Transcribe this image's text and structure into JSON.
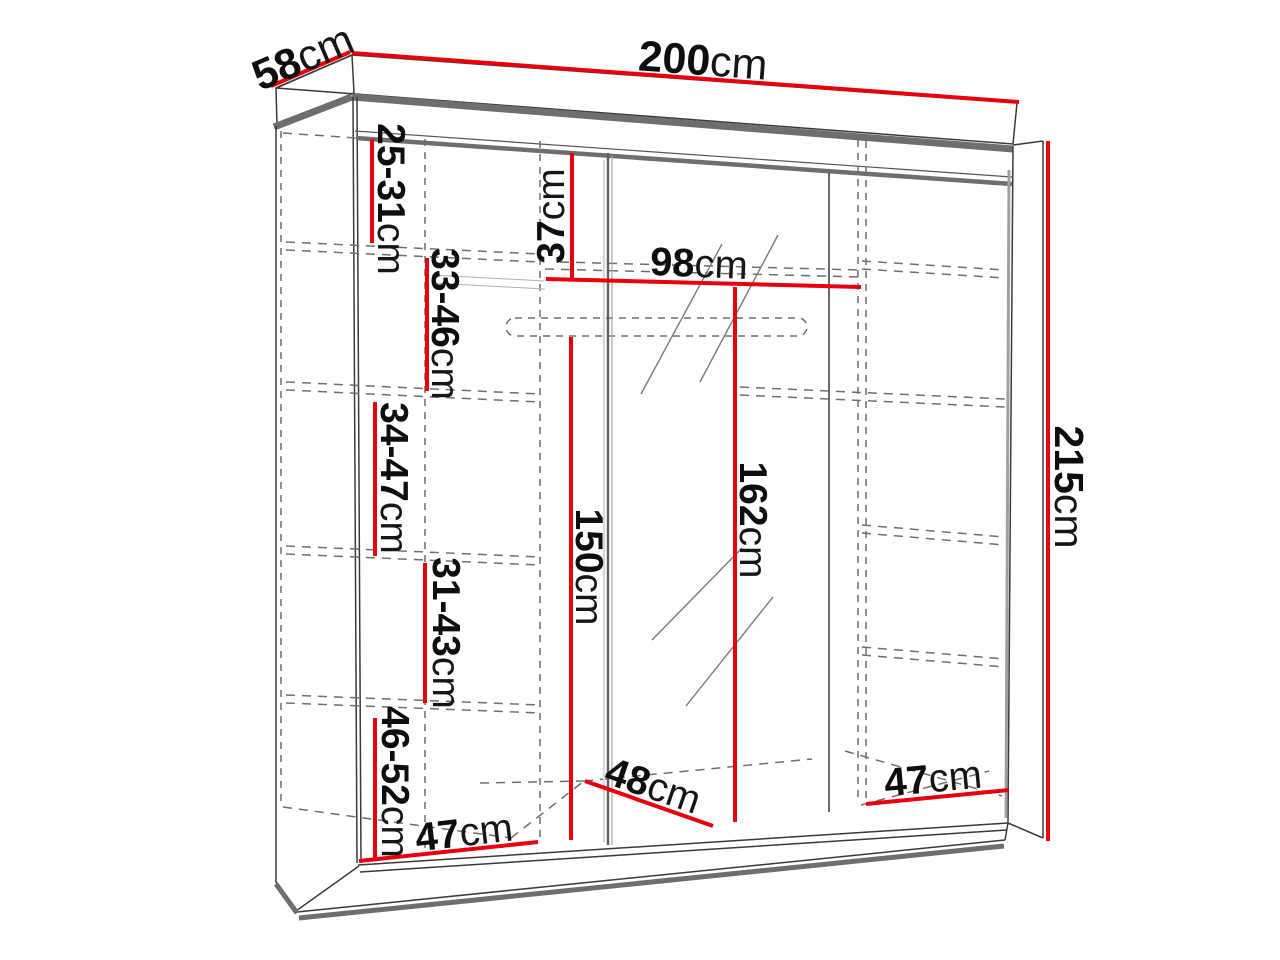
{
  "diagram": {
    "type": "wardrobe-dimensions-diagram",
    "unit": "cm",
    "accent_color": "#e8000d",
    "structure_color": "#3a3a3a",
    "shadow_color": "#6e6e6e",
    "hidden_line_color": "#6f6f6f",
    "text_color": "#0e0e0e",
    "labels": {
      "depth_top": {
        "value": "58",
        "unit": "cm"
      },
      "width_top": {
        "value": "200",
        "unit": "cm"
      },
      "height_right": {
        "value": "215",
        "unit": "cm"
      },
      "left_sec_1": {
        "value": "25-31",
        "unit": "cm"
      },
      "left_sec_2": {
        "value": "33-46",
        "unit": "cm"
      },
      "left_sec_3": {
        "value": "34-47",
        "unit": "cm"
      },
      "left_sec_4": {
        "value": "31-43",
        "unit": "cm"
      },
      "left_sec_5": {
        "value": "46-52",
        "unit": "cm"
      },
      "mid_top_offset": {
        "value": "37",
        "unit": "cm"
      },
      "mid_shelf_width": {
        "value": "98",
        "unit": "cm"
      },
      "mid_rail_height": {
        "value": "150",
        "unit": "cm"
      },
      "mid_clear_height": {
        "value": "162",
        "unit": "cm"
      },
      "bottom_left_width": {
        "value": "47",
        "unit": "cm"
      },
      "bottom_mid_depth": {
        "value": "48",
        "unit": "cm"
      },
      "bottom_right_width": {
        "value": "47",
        "unit": "cm"
      }
    }
  }
}
